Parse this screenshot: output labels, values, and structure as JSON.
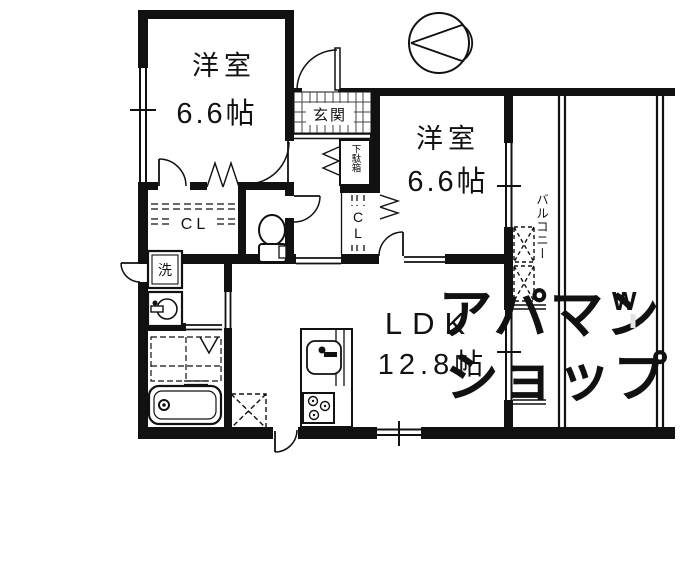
{
  "floor_plan": {
    "rooms": {
      "bedroom1": {
        "label": "洋室",
        "size": "6.6帖"
      },
      "bedroom2": {
        "label": "洋室",
        "size": "6.6帖"
      },
      "ldk": {
        "label": "LDK",
        "size": "12.8帖"
      },
      "entrance": {
        "label": "玄関"
      },
      "shoe_cabinet": {
        "label": "下駄箱"
      },
      "closet1": {
        "label": "CL"
      },
      "closet2": {
        "label": "CL"
      },
      "laundry": {
        "label": "洗"
      },
      "balcony": {
        "label": "バルコニー"
      }
    },
    "watermark": {
      "line1": "アパマン",
      "line2": "ショップ",
      "mark": "W"
    },
    "colors": {
      "wall": "#111111",
      "watermark": "#e3e3e3",
      "background": "#ffffff"
    }
  }
}
